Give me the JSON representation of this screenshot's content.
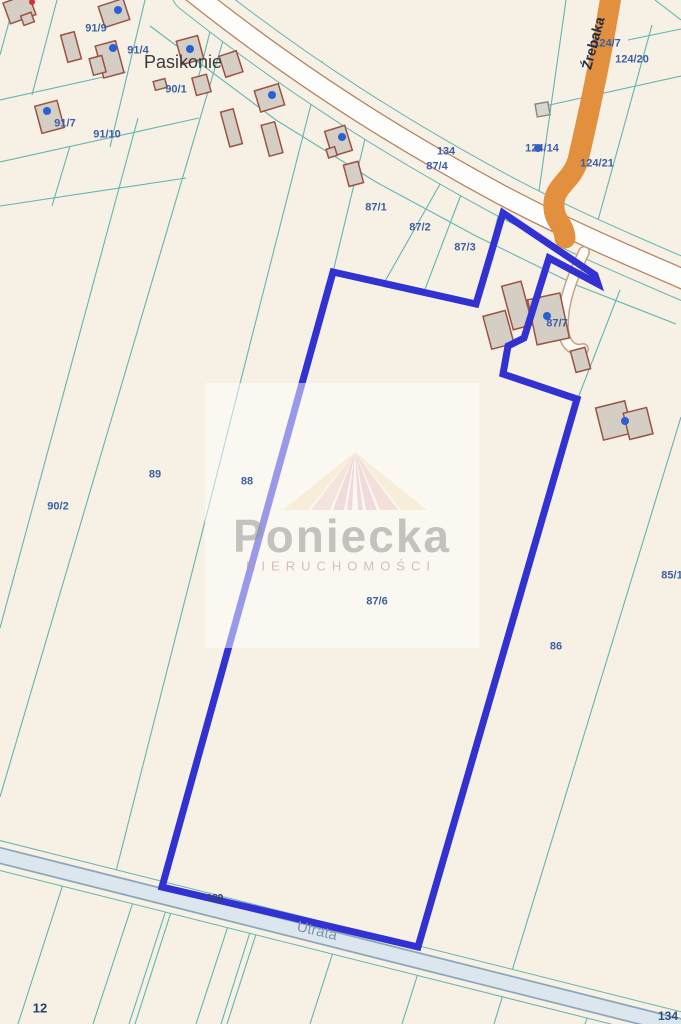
{
  "map": {
    "place_label": "Pasikonie",
    "street_vertical": "Źrebaka",
    "street_horizontal": "Utrata",
    "watermark": {
      "brand": "Poniecka",
      "subtitle": "NIERUCHOMOŚCI"
    },
    "colors": {
      "background": "#f7f1e5",
      "cadastral_line": "#62b5b2",
      "road_edge": "#b5825f",
      "road_fill": "#fdfdfc",
      "utrata_edge": "#8ca6bc",
      "utrata_fill": "#dce6ee",
      "orange_road": "#e28f3e",
      "selected_parcel_outline": "#3132d1",
      "parcel_label": "#3b5fa6",
      "address_point": "#2b5fd4",
      "building_fill": "#d5cec4",
      "building_stroke": "#9c5243"
    },
    "labels": {
      "p91_9": "91/9",
      "p91_4": "91/4",
      "p90_1": "90/1",
      "p91_7": "91/7",
      "p91_10": "91/10",
      "p134_road": "134",
      "p87_4": "87/4",
      "p87_1": "87/1",
      "p87_2": "87/2",
      "p87_3": "87/3",
      "p124_7": "124/7",
      "p124_20": "124/20",
      "p124_14": "124/14",
      "p124_21": "124/21",
      "p87_7": "87/7",
      "p87_6": "87/6",
      "p88": "88",
      "p89": "89",
      "p90_2": "90/2",
      "p86": "86",
      "p85_1": "85/1",
      "p12": "12",
      "p139": "139",
      "p134_bottom": "134"
    }
  }
}
